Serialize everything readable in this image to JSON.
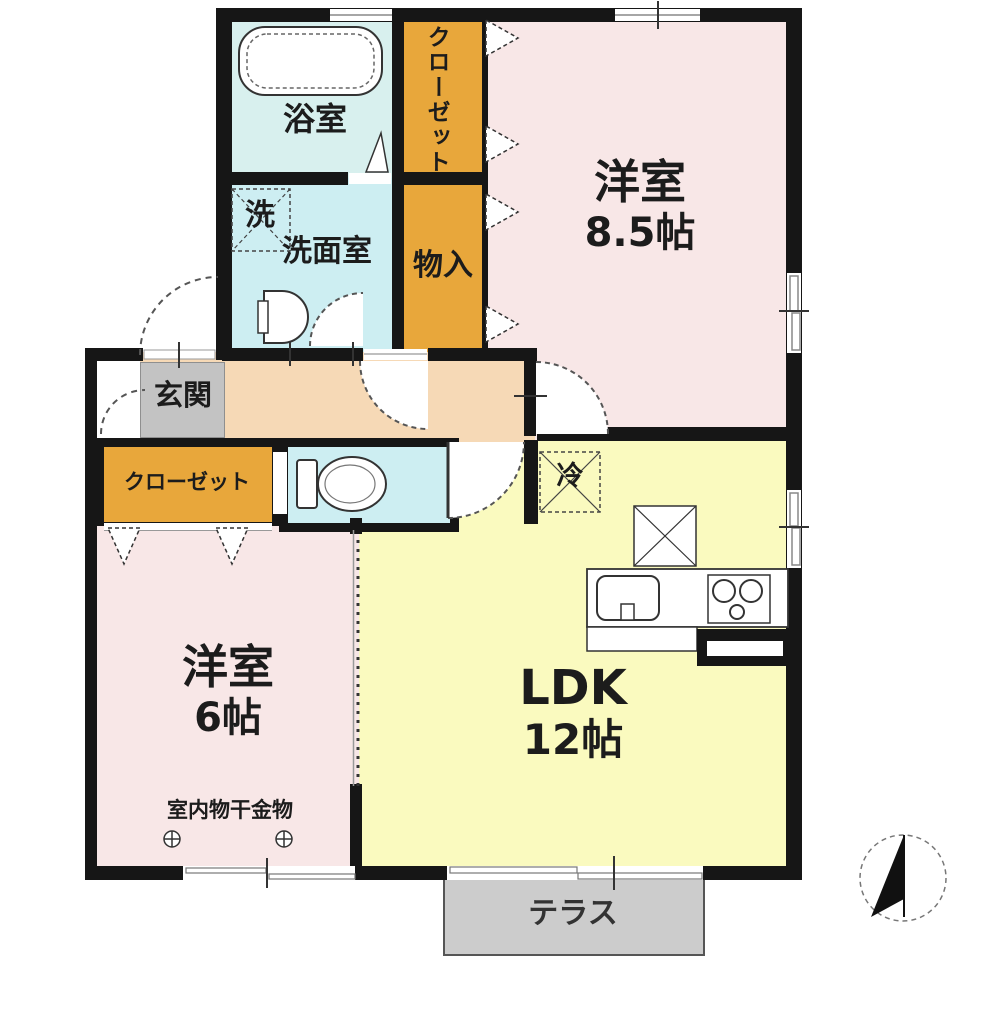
{
  "floor_plan": {
    "rooms": {
      "bath": {
        "name": "浴室"
      },
      "washer": {
        "name": "洗"
      },
      "washroom": {
        "name": "洗面室"
      },
      "closet_top": {
        "name": "クローゼット"
      },
      "storage": {
        "name": "物入"
      },
      "bedroom_main": {
        "name": "洋室",
        "size": "8.5帖"
      },
      "entrance": {
        "name": "玄関"
      },
      "closet_side": {
        "name": "クローゼット"
      },
      "fridge": {
        "name": "冷"
      },
      "bedroom_second": {
        "name": "洋室",
        "size": "6帖",
        "note": "室内物干金物"
      },
      "ldk": {
        "name": "LDK",
        "size": "12帖"
      },
      "terrace": {
        "name": "テラス"
      }
    },
    "colors": {
      "wall": "#161616",
      "bedroom_pink": "#f8e7e7",
      "ldk_yellow": "#fafabf",
      "wet_cyan": "#cdeef2",
      "closet_orange": "#e8a73b",
      "hall_peach": "#f6d9b6",
      "entrance_tile": "#c3c3c3",
      "terrace_gray": "#cccccc"
    }
  }
}
